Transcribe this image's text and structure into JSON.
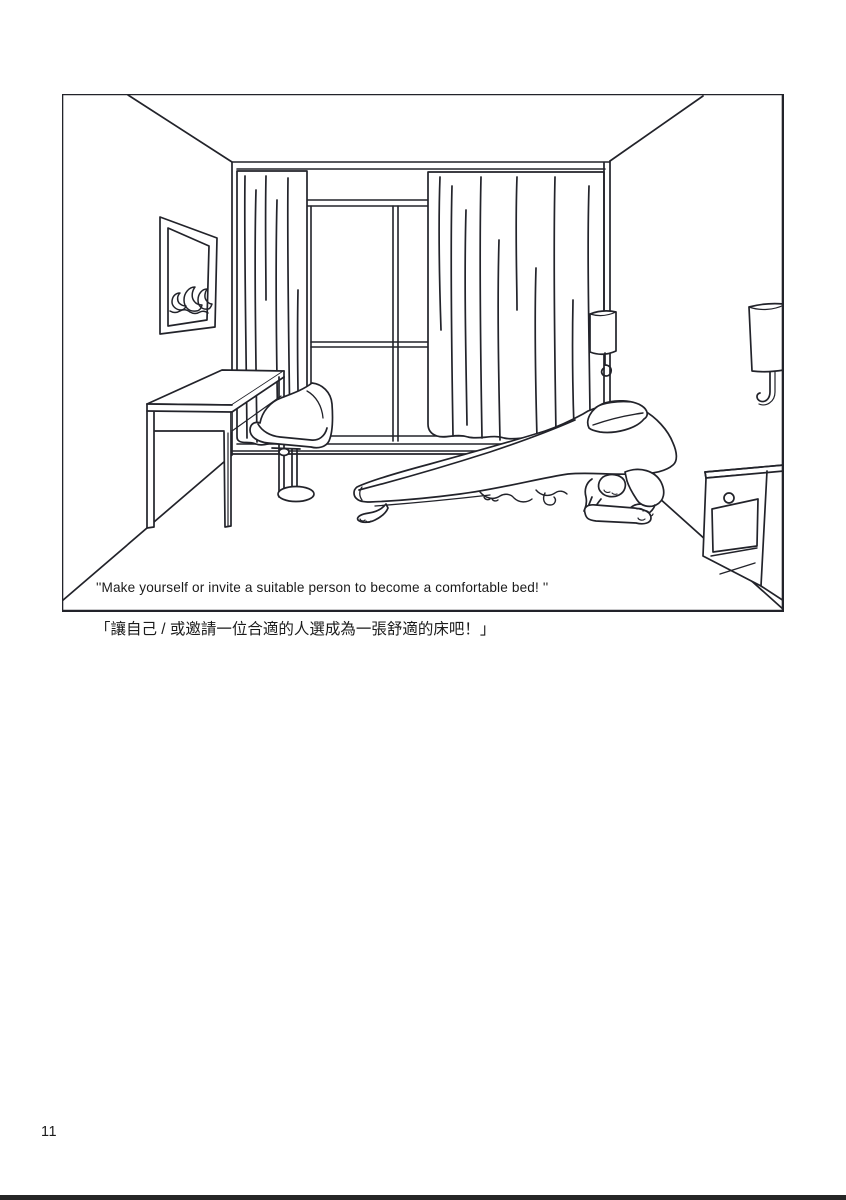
{
  "page": {
    "number": "11",
    "caption_en": "''Make yourself or invite a suitable person to become a comfortable bed! ''",
    "caption_zh": "「讓自己 / 或邀請一位合適的人選成為一張舒適的床吧！」"
  },
  "illustration": {
    "alt": "Black-and-white line drawing of a room: framed picture with waves, curtained window, desk with pedestal chair, hanging pendant lamp, wall lamp, nightstand, and a kneeling person supporting a mattress with a pillow like a human bed"
  },
  "colors": {
    "ink": "#22232a",
    "paper": "#ffffff",
    "footer_bar": "#262626"
  }
}
